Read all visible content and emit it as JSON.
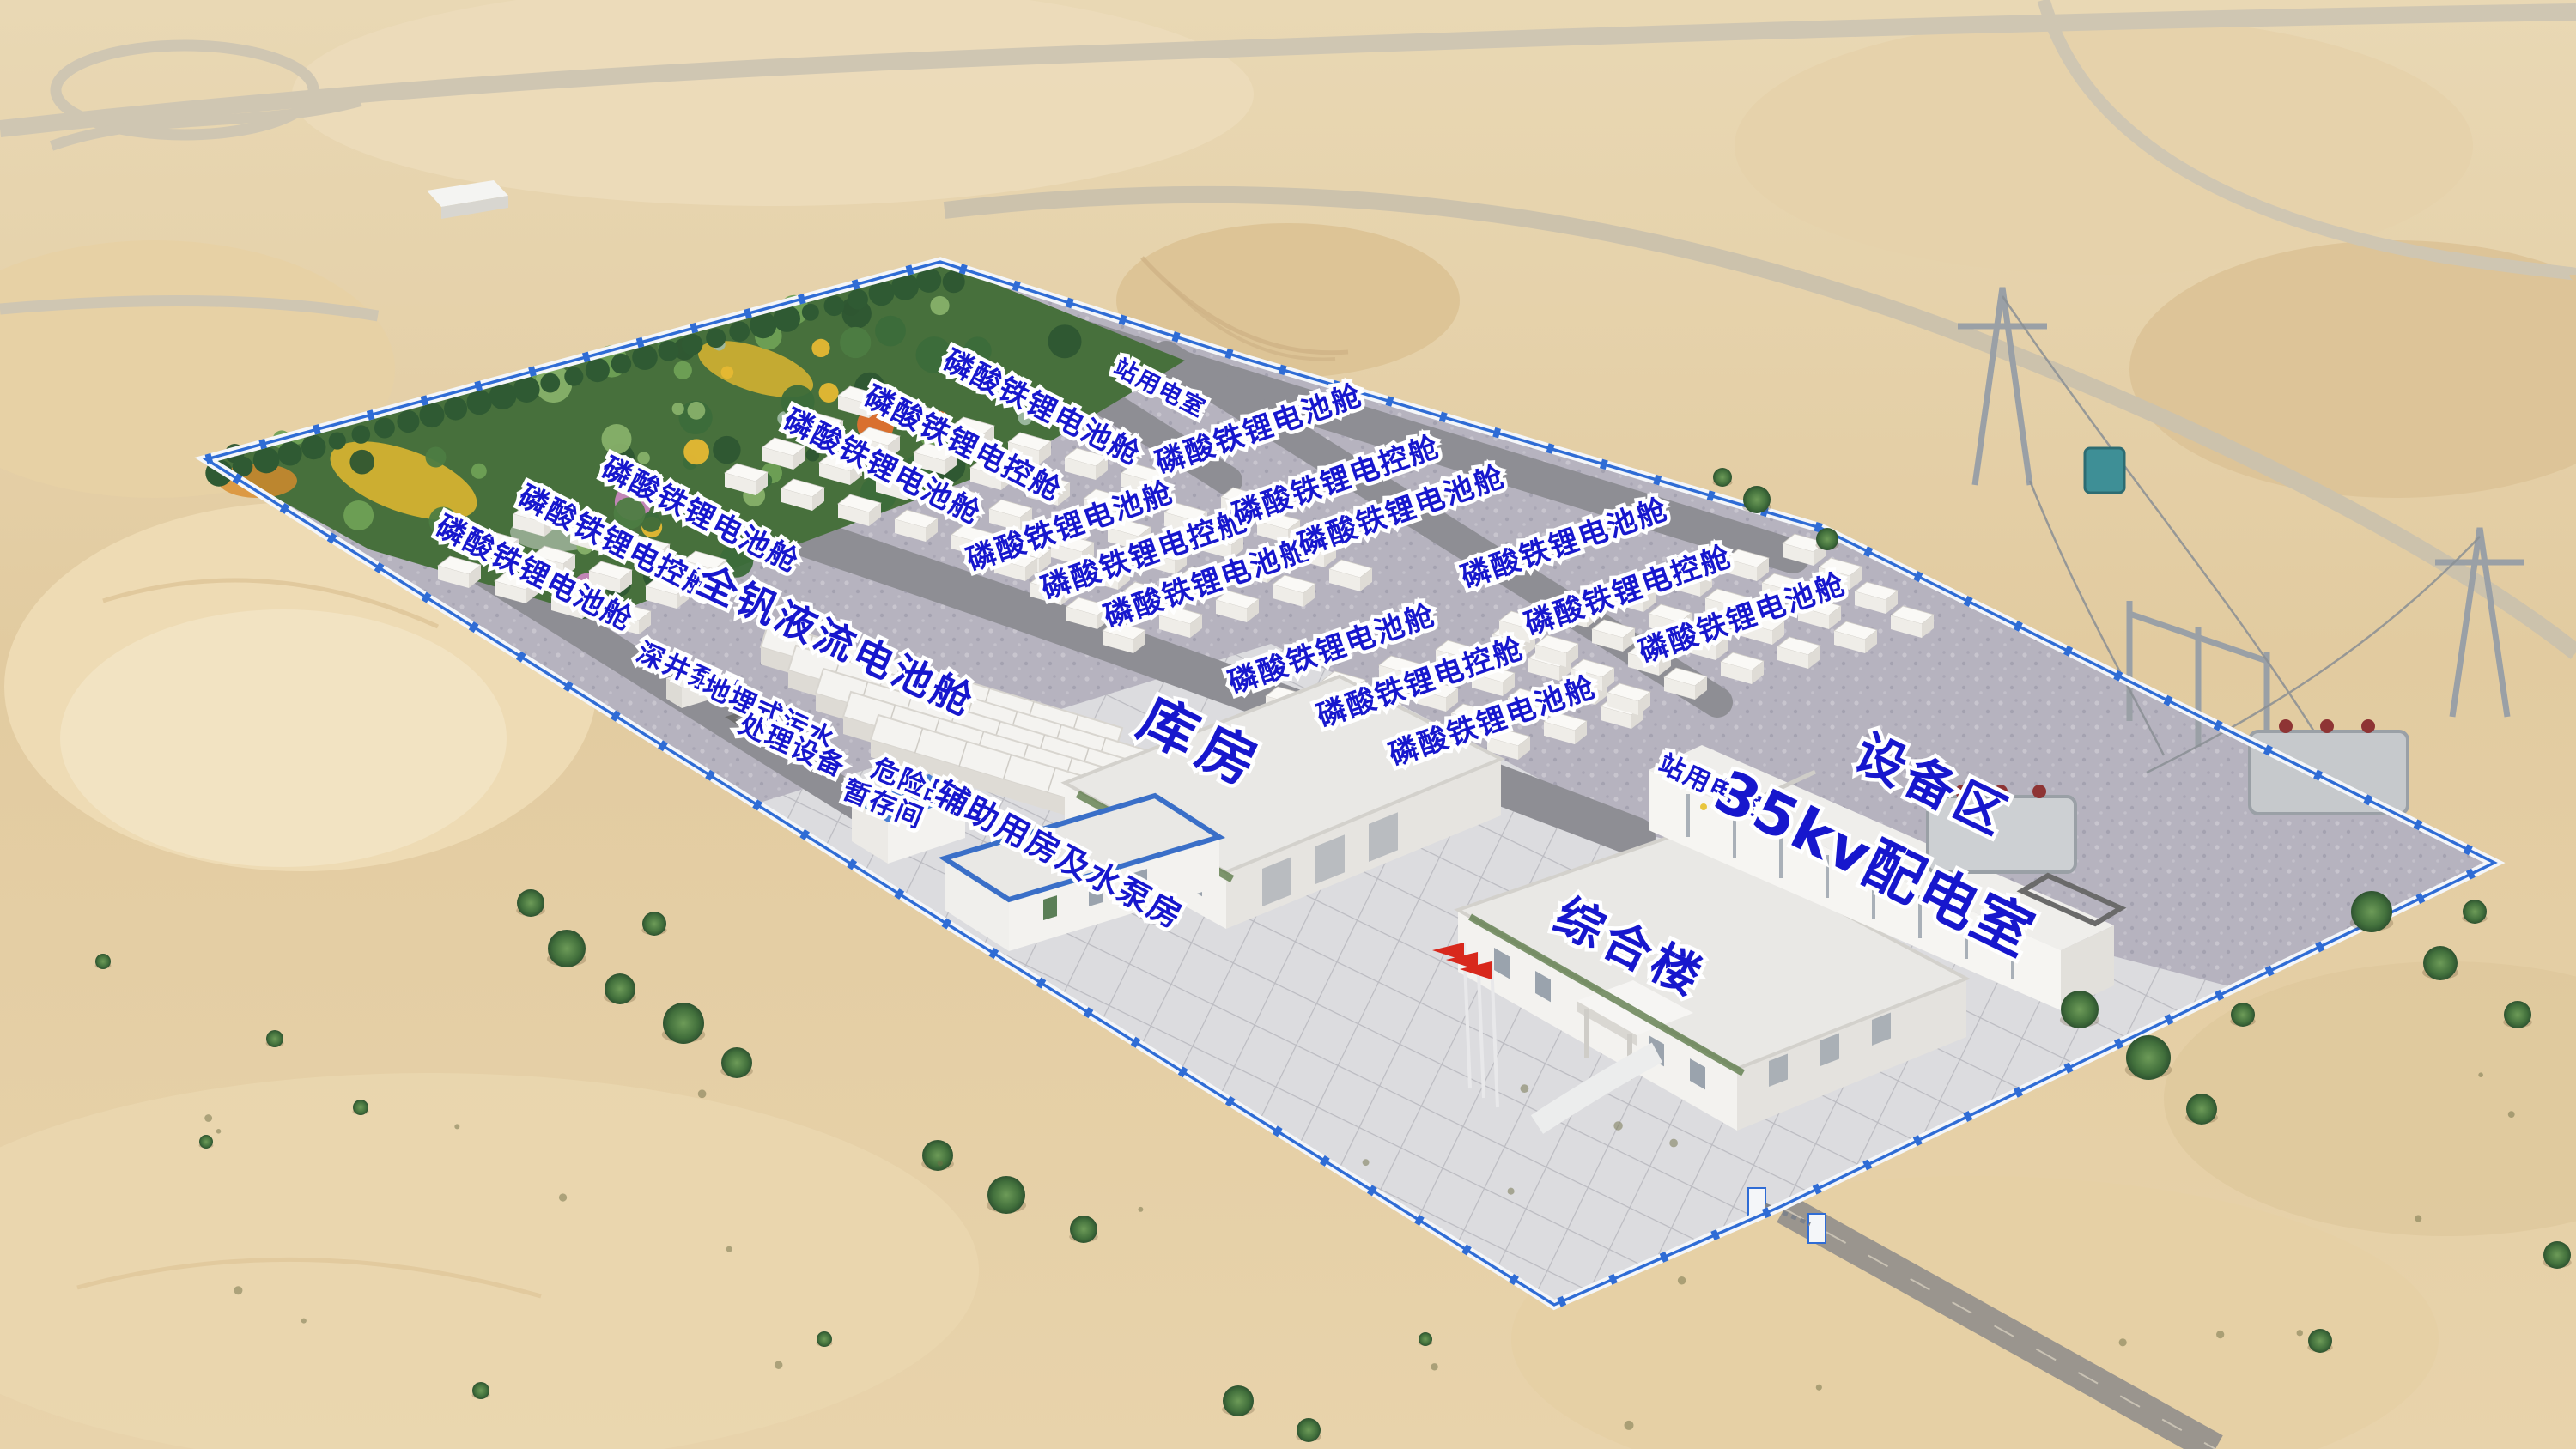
{
  "site_labels": [
    {
      "id": "station-power-room-north",
      "text": "站用电室"
    },
    {
      "id": "lfp-battery-1",
      "text": "磷酸铁锂电池舱"
    },
    {
      "id": "lfp-control-1",
      "text": "磷酸铁锂电控舱"
    },
    {
      "id": "lfp-battery-2",
      "text": "磷酸铁锂电池舱"
    },
    {
      "id": "lfp-battery-3",
      "text": "磷酸铁锂电池舱"
    },
    {
      "id": "lfp-control-2",
      "text": "磷酸铁锂电控舱"
    },
    {
      "id": "lfp-battery-4",
      "text": "磷酸铁锂电池舱"
    },
    {
      "id": "lfp-battery-5",
      "text": "磷酸铁锂电池舱"
    },
    {
      "id": "lfp-control-3",
      "text": "磷酸铁锂电控舱"
    },
    {
      "id": "lfp-battery-6",
      "text": "磷酸铁锂电池舱"
    },
    {
      "id": "lfp-battery-7",
      "text": "磷酸铁锂电池舱"
    },
    {
      "id": "lfp-control-4",
      "text": "磷酸铁锂电控舱"
    },
    {
      "id": "lfp-battery-8",
      "text": "磷酸铁锂电池舱"
    },
    {
      "id": "lfp-battery-9",
      "text": "磷酸铁锂电池舱"
    },
    {
      "id": "lfp-control-5",
      "text": "磷酸铁锂电控舱"
    },
    {
      "id": "lfp-battery-10",
      "text": "磷酸铁锂电池舱"
    },
    {
      "id": "lfp-battery-11",
      "text": "磷酸铁锂电池舱"
    },
    {
      "id": "lfp-control-6",
      "text": "磷酸铁锂电控舱"
    },
    {
      "id": "lfp-battery-12",
      "text": "磷酸铁锂电池舱"
    },
    {
      "id": "vanadium-flow-battery",
      "text": "全钒液流电池舱"
    },
    {
      "id": "deep-well-pump",
      "text": "深井泵井"
    },
    {
      "id": "buried-sewage-line1",
      "text": "地埋式污水"
    },
    {
      "id": "buried-sewage-line2",
      "text": "处理设备"
    },
    {
      "id": "hazmat-room-line1",
      "text": "危险品"
    },
    {
      "id": "hazmat-room-line2",
      "text": "暂存间"
    },
    {
      "id": "auxiliary-pump-house",
      "text": "辅助用房及水泵房"
    },
    {
      "id": "warehouse",
      "text": "库房"
    },
    {
      "id": "comprehensive-building",
      "text": "综合楼"
    },
    {
      "id": "station-power-room-east",
      "text": "站用电室"
    },
    {
      "id": "distribution-room-35kv",
      "text": "35kv配电室"
    },
    {
      "id": "equipment-area",
      "text": "设备区"
    }
  ],
  "colors": {
    "label_blue": "#1717cd",
    "wall_blue": "#2f6cd5",
    "flag_red": "#d8281c",
    "sand": "#e3cda4",
    "site_gravel": "#b6b3bf",
    "road_gray": "#8e8e94",
    "plaza_concrete": "#dcdcdf",
    "tree_green": "#3f6b39",
    "roof_white": "#f2f1ee"
  }
}
